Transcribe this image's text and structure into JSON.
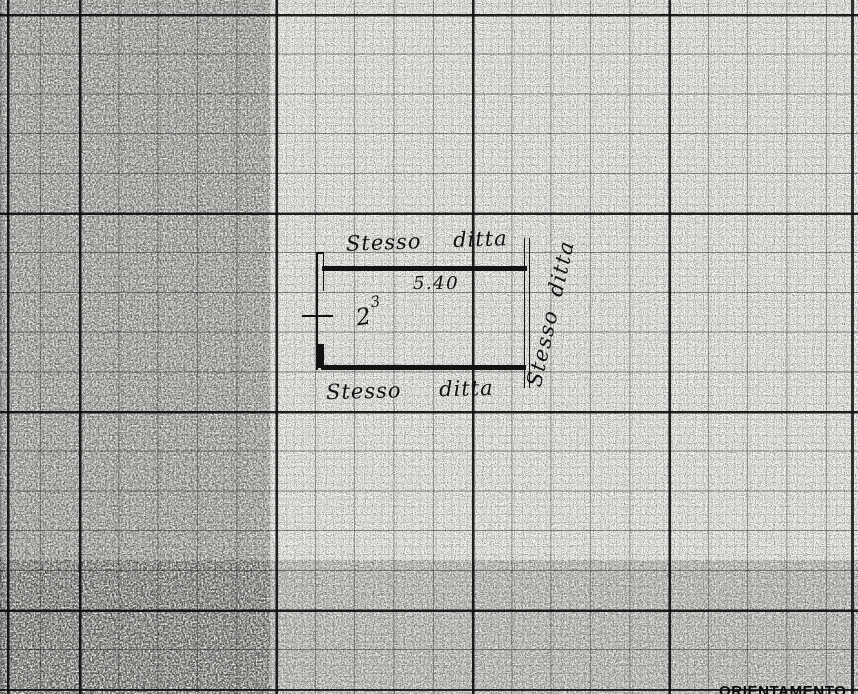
{
  "plan": {
    "label_top": "Stesso ditta",
    "label_bottom": "Stesso ditta",
    "label_right_vertical": "Stesso ditta",
    "dimension_width": "5.40",
    "room_number": "2",
    "room_superscript": "3"
  },
  "footer": {
    "clipped_text": "ORIENTAMENTO"
  },
  "colors": {
    "paper": "#fdfdfa",
    "ink": "#161616",
    "grid_major": "#141414"
  }
}
